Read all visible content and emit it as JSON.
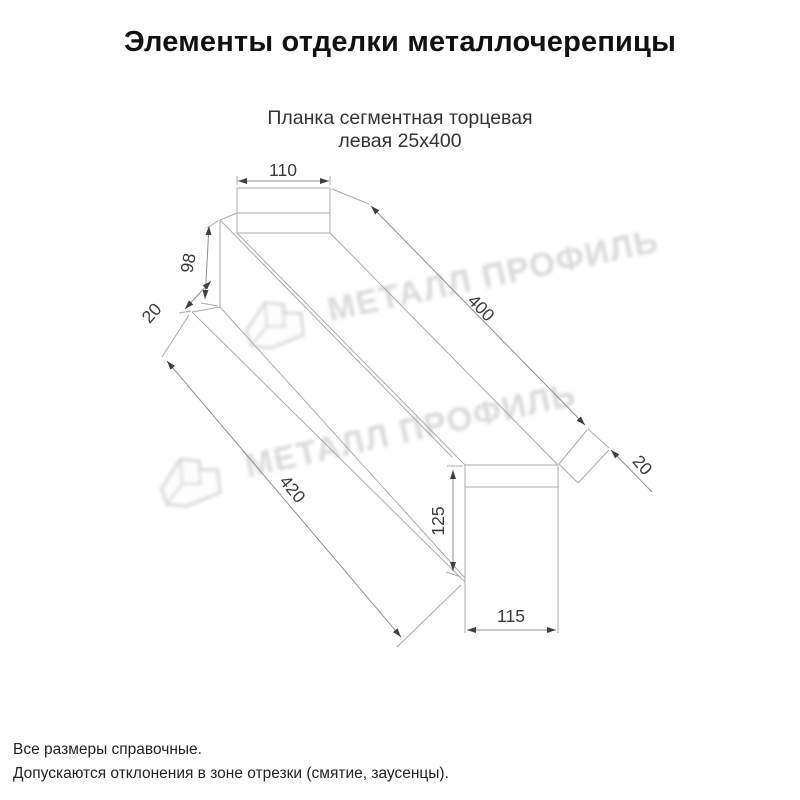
{
  "title": "Элементы отделки металлочерепицы",
  "subtitle": {
    "line1": "Планка сегментная торцевая",
    "line2": "левая 25х400"
  },
  "watermark": {
    "text": "МЕТАЛЛ ПРОФИЛЬ"
  },
  "dimensions": {
    "top_width_110": "110",
    "left_height_98": "98",
    "left_fold_20": "20",
    "top_length_400": "400",
    "bottom_length_420": "420",
    "end_height_125": "125",
    "end_width_115": "115",
    "right_fold_20": "20"
  },
  "footnotes": [
    "Все размеры справочные.",
    "Допускаются отклонения в зоне отрезки (смятие, заусенцы)."
  ],
  "colors": {
    "background": "#ffffff",
    "line": "#ababab",
    "dimension_text": "#3a3a3a",
    "watermark": "#d8d8d8"
  }
}
